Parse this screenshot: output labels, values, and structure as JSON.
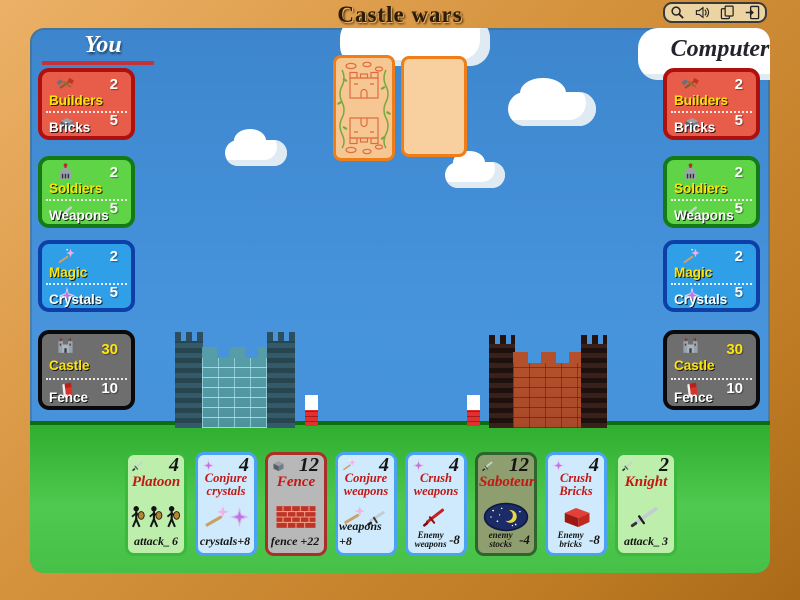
{
  "window": {
    "title": "Castle wars",
    "toolbar": {
      "buttons": [
        "zoom",
        "sound",
        "cards",
        "exit"
      ]
    }
  },
  "players": {
    "you": {
      "label": "You",
      "panels": [
        {
          "top_label": "Builders",
          "top_value": "2",
          "bottom_label": "Bricks",
          "bottom_value": "5"
        },
        {
          "top_label": "Soldiers",
          "top_value": "2",
          "bottom_label": "Weapons",
          "bottom_value": "5"
        },
        {
          "top_label": "Magic",
          "top_value": "2",
          "bottom_label": "Crystals",
          "bottom_value": "5"
        },
        {
          "top_label": "Castle",
          "top_value": "30",
          "bottom_label": "Fence",
          "bottom_value": "10"
        }
      ]
    },
    "computer": {
      "label": "Computer",
      "panels": [
        {
          "top_label": "Builders",
          "top_value": "2",
          "bottom_label": "Bricks",
          "bottom_value": "5"
        },
        {
          "top_label": "Soldiers",
          "top_value": "2",
          "bottom_label": "Weapons",
          "bottom_value": "5"
        },
        {
          "top_label": "Magic",
          "top_value": "2",
          "bottom_label": "Crystals",
          "bottom_value": "5"
        },
        {
          "top_label": "Castle",
          "top_value": "30",
          "bottom_label": "Fence",
          "bottom_value": "10"
        }
      ]
    }
  },
  "hand": {
    "cards": [
      {
        "title": "Platoon",
        "cost": "4",
        "effect": "attack_",
        "modifier": "6"
      },
      {
        "title": "Conjure crystals",
        "cost": "4",
        "effect": "crystals+8",
        "modifier": ""
      },
      {
        "title": "Fence",
        "cost": "12",
        "effect": "fence +22",
        "modifier": ""
      },
      {
        "title": "Conjure weapons",
        "cost": "4",
        "effect": "weapons +8",
        "modifier": ""
      },
      {
        "title": "Crush weapons",
        "cost": "4",
        "effect": "Enemy weapons",
        "modifier": "-8"
      },
      {
        "title": "Saboteur",
        "cost": "12",
        "effect": "enemy stocks",
        "modifier": "-4"
      },
      {
        "title": "Crush Bricks",
        "cost": "4",
        "effect": "Enemy bricks",
        "modifier": "-8"
      },
      {
        "title": "Knight",
        "cost": "2",
        "effect": "attack_",
        "modifier": "3"
      }
    ]
  },
  "colors": {
    "sky": "#4390d8",
    "grass": "#3fbf3f",
    "frame": "#d6943f",
    "panel_red": "#e85c4a",
    "panel_green": "#5fd447",
    "panel_blue": "#2f9fe8",
    "panel_dark": "#6e6e6e",
    "label_yellow": "#ffe40a",
    "card_title_red": "#c21814",
    "card_orange_border": "#ef7d18"
  }
}
